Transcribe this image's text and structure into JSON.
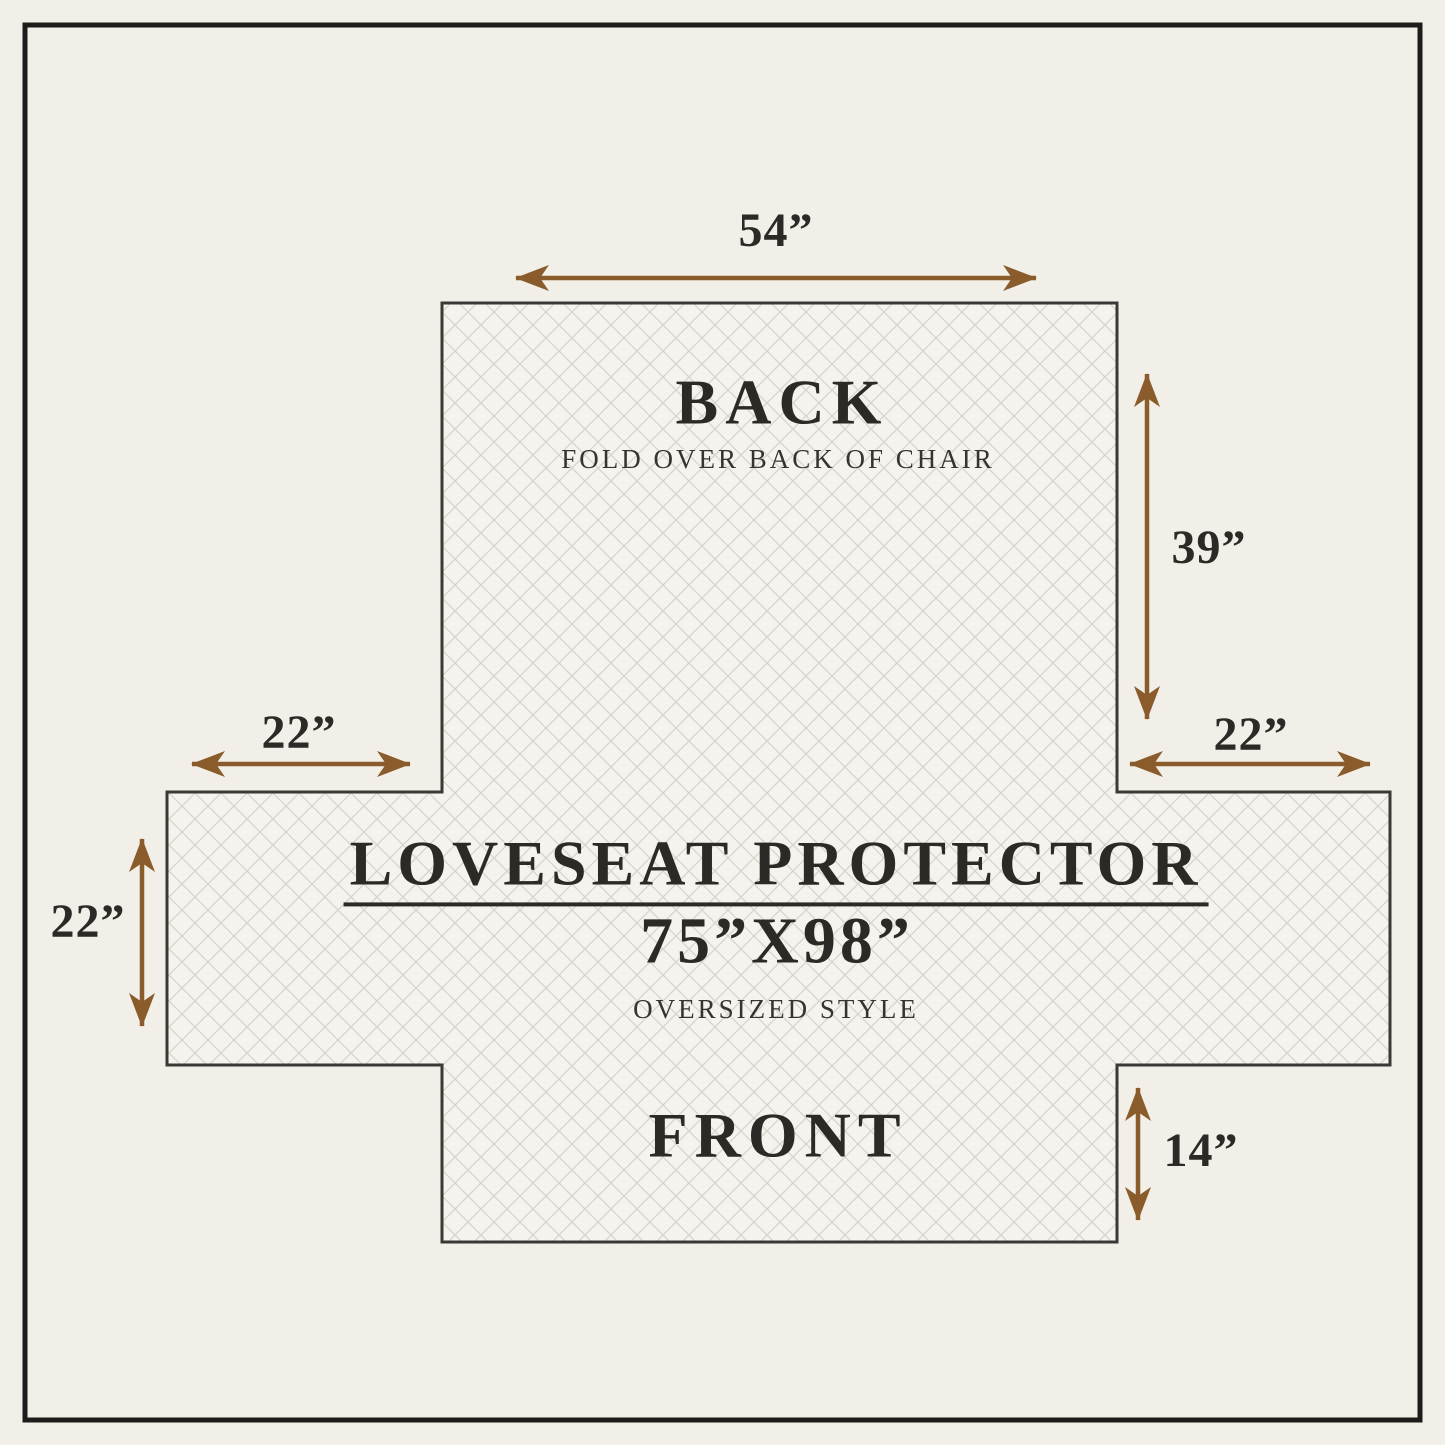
{
  "labels": {
    "back": "BACK",
    "back_note": "FOLD OVER BACK OF CHAIR",
    "title": "LOVESEAT PROTECTOR",
    "size": "75”X98”",
    "style_note": "OVERSIZED STYLE",
    "front": "FRONT"
  },
  "dimensions": {
    "back_width": "54”",
    "back_height": "39”",
    "left_flap_width": "22”",
    "left_flap_height": "22”",
    "right_flap_width": "22”",
    "front_height": "14”"
  },
  "colors": {
    "arrow": "#8a5c2b",
    "text": "#2b2a27",
    "background": "#f2efe8",
    "fabric": "#f5f3ed",
    "lattice": "#d8d4cd",
    "outline": "#3b3936",
    "frame": "#1d1c1a"
  }
}
